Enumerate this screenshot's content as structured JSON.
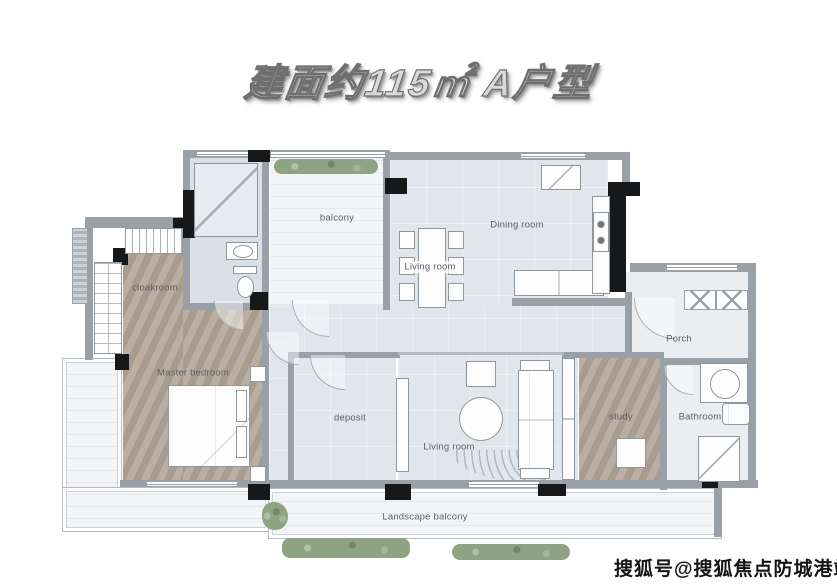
{
  "title": {
    "text": "建面约115㎡ A户型"
  },
  "watermark": {
    "text": "搜狐号@搜狐焦点防城港站"
  },
  "rooms": [
    {
      "id": "cloakroom",
      "label": "cloakroom"
    },
    {
      "id": "balcony",
      "label": "balcony"
    },
    {
      "id": "living-room-dining",
      "label": "Living room"
    },
    {
      "id": "dining-room",
      "label": "Dining room"
    },
    {
      "id": "porch",
      "label": "Porch"
    },
    {
      "id": "master-bedroom",
      "label": "Master bedroom"
    },
    {
      "id": "deposit",
      "label": "deposit"
    },
    {
      "id": "living-room",
      "label": "Living room"
    },
    {
      "id": "study",
      "label": "study"
    },
    {
      "id": "bathroom",
      "label": "Bathroom"
    },
    {
      "id": "landscape-balcony",
      "label": "Landscape balcony"
    }
  ],
  "colors": {
    "wall_gray": "#99a0a7",
    "wall_black": "#17181a",
    "wood_floor": "#b2a697",
    "light_floor": "#e1e5ec",
    "marble_floor": "#f3f4f6",
    "plant_green": "#8ea381",
    "label_text": "#5b6066"
  }
}
